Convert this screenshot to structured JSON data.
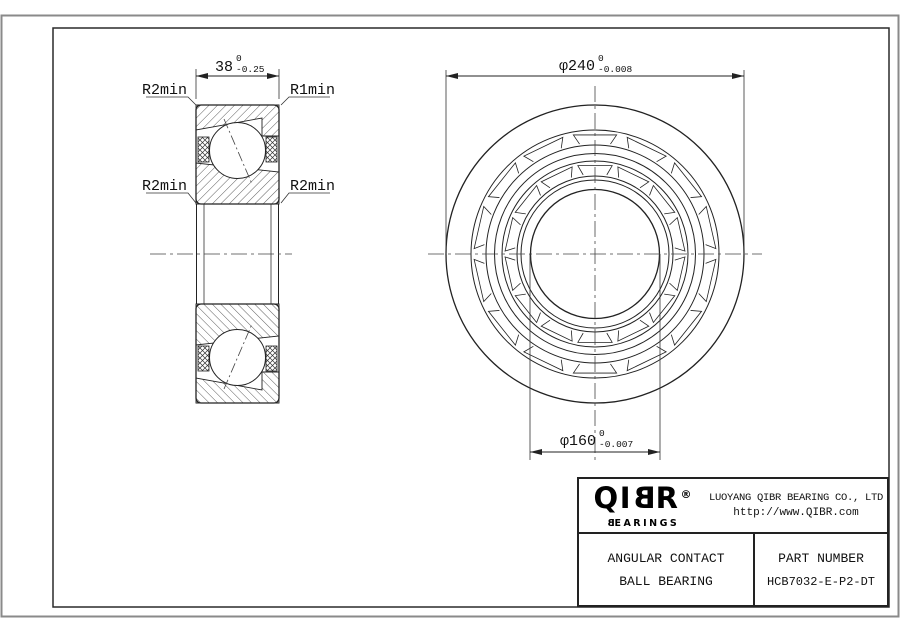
{
  "left_view": {
    "dim_width": {
      "value": "38",
      "tol_upper": "0",
      "tol_lower": "-0.25"
    },
    "labels": {
      "top_left": "R2min",
      "top_right": "R1min",
      "mid_left": "R2min",
      "mid_right": "R2min"
    }
  },
  "right_view": {
    "dim_outer": {
      "value": "φ240",
      "tol_upper": "0",
      "tol_lower": "-0.008"
    },
    "dim_bore": {
      "value": "φ160",
      "tol_upper": "0",
      "tol_lower": "-0.007"
    }
  },
  "title_block": {
    "logo": {
      "part1": "QI",
      "mirrored_b": "B",
      "part2": "R",
      "registered": "®",
      "sub_mirrored_b": "B",
      "sub_rest": "EARINGS"
    },
    "company": "LUOYANG QIBR BEARING CO., LTD",
    "website": "http://www.QIBR.com",
    "product_line1": "ANGULAR CONTACT",
    "product_line2": "BALL BEARING",
    "part_number_label": "PART NUMBER",
    "part_number": "HCB7032-E-P2-DT"
  },
  "colors": {
    "line": "#222222",
    "border_gray": "#8a8a8a",
    "background": "#ffffff"
  }
}
